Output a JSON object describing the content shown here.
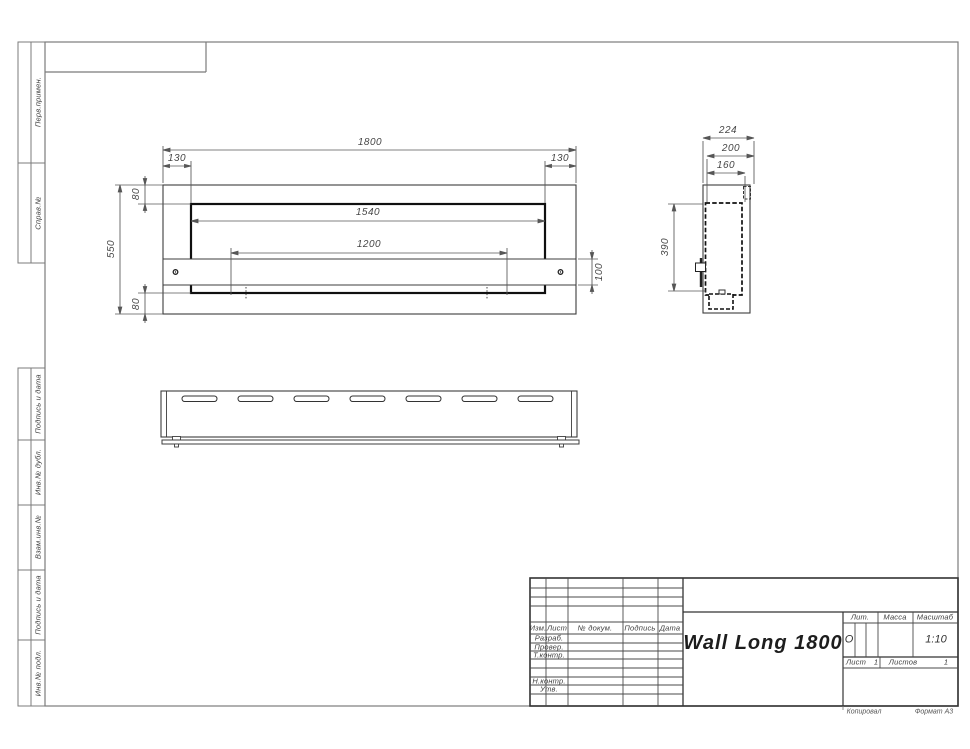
{
  "sheet": {
    "copied_label": "Копировал",
    "format_label": "Формат А3"
  },
  "sidebar": {
    "items": [
      {
        "label": "Перв.примен."
      },
      {
        "label": "Справ.№"
      },
      {
        "label": "Подпись и дата"
      },
      {
        "label": "Инв.№ дубл."
      },
      {
        "label": "Взам.инв.№"
      },
      {
        "label": "Подпись и дата"
      },
      {
        "label": "Инв.№ подл."
      }
    ]
  },
  "front_view": {
    "overall_width": "1800",
    "left_offset": "130",
    "right_offset": "130",
    "top_flange": "80",
    "overall_height": "550",
    "bottom_flange": "80",
    "opening_width": "1540",
    "inner_span": "1200",
    "strip_height": "100"
  },
  "side_view": {
    "overall_depth": "224",
    "inner_depth": "200",
    "opening_depth": "160",
    "opening_height": "390"
  },
  "title_block": {
    "header_cols": [
      "Изм.",
      "Лист",
      "№ докум.",
      "Подпись",
      "Дата"
    ],
    "rows": [
      "Разраб.",
      "Провер.",
      "Т.контр.",
      "Н.контр.",
      "Утв."
    ],
    "title": "Wall Long 1800",
    "lit_label": "Лит.",
    "lit_value": "О",
    "mass_label": "Масса",
    "scale_label": "Масштаб",
    "scale_value": "1:10",
    "sheet_label": "Лист",
    "sheet_value": "1",
    "sheets_label": "Листов",
    "sheets_value": "1"
  }
}
